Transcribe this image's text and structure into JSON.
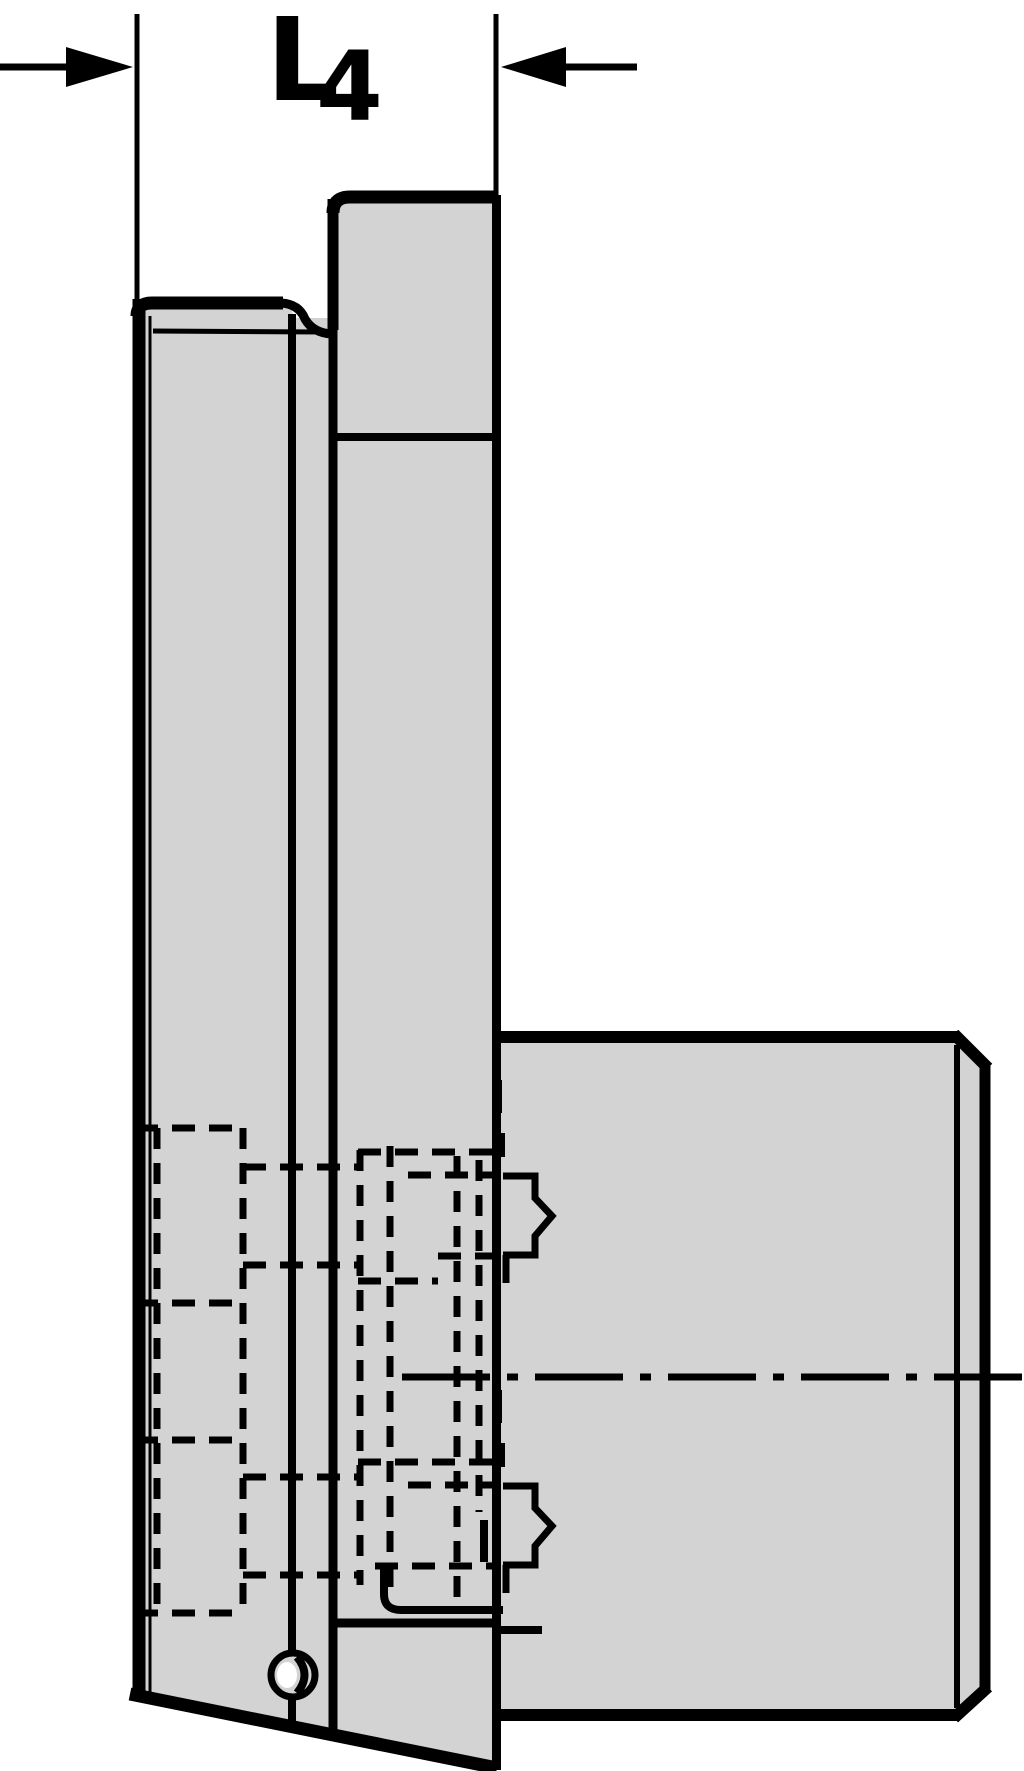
{
  "dimension": {
    "label": "L",
    "subscript": "4"
  },
  "colors": {
    "line": "#000000",
    "part_fill": "#d3d3d3",
    "background": "#ffffff"
  }
}
